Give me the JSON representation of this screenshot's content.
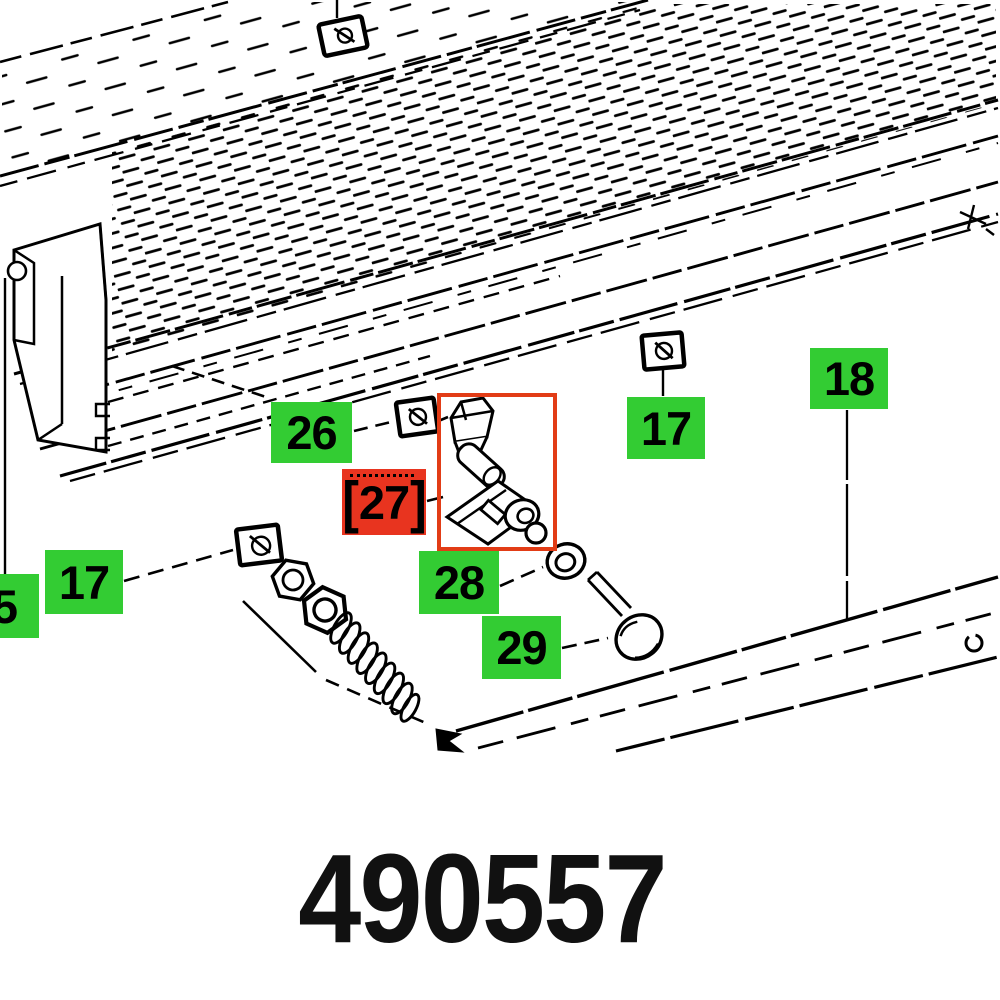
{
  "page": {
    "background": "#ffffff"
  },
  "colors": {
    "label_green": "#33cc33",
    "label_red": "#e8341f",
    "highlight_red": "#e23c16",
    "line_black": "#000000"
  },
  "part_number": "490557",
  "labels": [
    {
      "id": "26",
      "text": "26",
      "style": "green"
    },
    {
      "id": "27",
      "text": "27",
      "style": "red",
      "selected": true,
      "bracket_left": "[",
      "bracket_right": "]"
    },
    {
      "id": "28",
      "text": "28",
      "style": "green"
    },
    {
      "id": "29",
      "text": "29",
      "style": "green"
    },
    {
      "id": "17r",
      "text": "17",
      "style": "green"
    },
    {
      "id": "18",
      "text": "18",
      "style": "green"
    },
    {
      "id": "17l",
      "text": "17",
      "style": "green"
    },
    {
      "id": "5",
      "text": "5",
      "style": "green"
    }
  ],
  "diagram": {
    "highlighted_part": "27",
    "icons": [
      "guide-rail-icon",
      "lower-rail-icon",
      "square-nut-icon",
      "hex-nut-icon",
      "washer-icon",
      "spring-icon",
      "knob-bolt-icon",
      "clamp-part-icon"
    ]
  }
}
